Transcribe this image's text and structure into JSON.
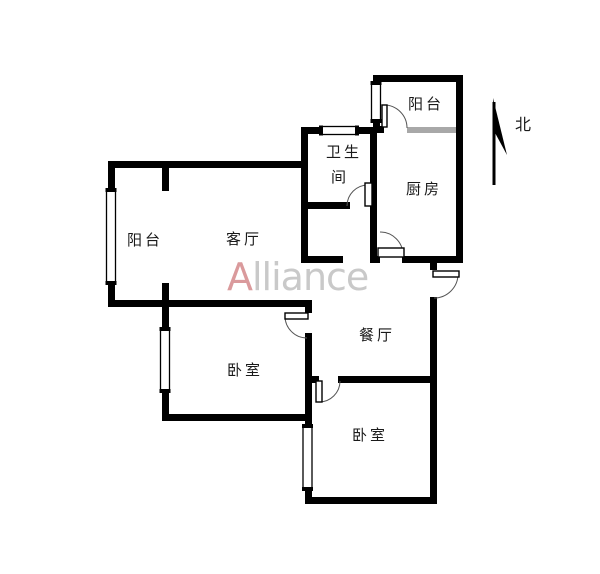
{
  "meta": {
    "type": "real-estate floor plan",
    "background": "#ffffff"
  },
  "watermark": {
    "logo_letter": "A",
    "text": "lliance",
    "accent_color": "#d4898b",
    "text_color": "#c9c9c9"
  },
  "compass": {
    "label": "北",
    "direction": "north-arrow"
  },
  "rooms": {
    "balcony_top": {
      "label": "阳台"
    },
    "kitchen": {
      "label": "厨房"
    },
    "bathroom": {
      "label_line1": "卫生",
      "label_line2": "间"
    },
    "balcony_left": {
      "label": "阳台"
    },
    "living_room": {
      "label": "客厅"
    },
    "dining_room": {
      "label": "餐厅"
    },
    "bedroom_left": {
      "label": "卧室"
    },
    "bedroom_right": {
      "label": "卧室"
    }
  },
  "colors": {
    "wall": "#000000",
    "glass_panel": "#a8a8a8",
    "door_arc": "#555555",
    "label_text": "#1a1a1a"
  }
}
